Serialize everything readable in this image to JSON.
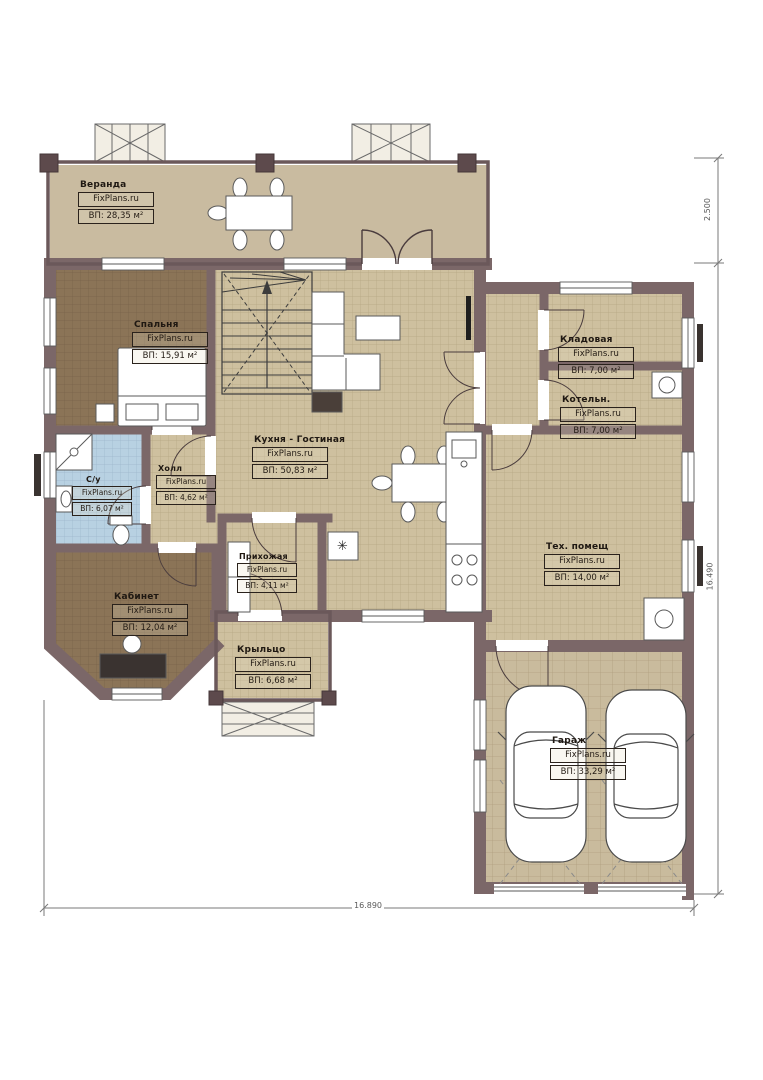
{
  "plan": {
    "watermark": "FixPlans.ru",
    "rooms": [
      {
        "id": "veranda",
        "name": "Веранда",
        "brand": "FixPlans.ru",
        "area": "ВП: 28,35 м²"
      },
      {
        "id": "spalnya",
        "name": "Спальня",
        "brand": "FixPlans.ru",
        "area": "ВП: 15,91 м²"
      },
      {
        "id": "kuhnya-gostinaya",
        "name": "Кухня - Гостиная",
        "brand": "FixPlans.ru",
        "area": "ВП: 50,83 м²"
      },
      {
        "id": "holl",
        "name": "Холл",
        "brand": "FixPlans.ru",
        "area": "ВП: 4,62 м²"
      },
      {
        "id": "sanuzel",
        "name": "С/у",
        "brand": "FixPlans.ru",
        "area": "ВП: 6,07 м²"
      },
      {
        "id": "kabinet",
        "name": "Кабинет",
        "brand": "FixPlans.ru",
        "area": "ВП: 12,04 м²"
      },
      {
        "id": "prihozhaya",
        "name": "Прихожая",
        "brand": "FixPlans.ru",
        "area": "ВП: 4,11 м²"
      },
      {
        "id": "krylco",
        "name": "Крыльцо",
        "brand": "FixPlans.ru",
        "area": "ВП: 6,68 м²"
      },
      {
        "id": "kladovaya",
        "name": "Кладовая",
        "brand": "FixPlans.ru",
        "area": "ВП: 7,00 м²"
      },
      {
        "id": "kotelnaya",
        "name": "Котельн.",
        "brand": "FixPlans.ru",
        "area": "ВП: 7,00 м²"
      },
      {
        "id": "teh-pomesch",
        "name": "Тех. помещ",
        "brand": "FixPlans.ru",
        "area": "ВП: 14,00 м²"
      },
      {
        "id": "garazh",
        "name": "Гараж",
        "brand": "FixPlans.ru",
        "area": "ВП: 33,29 м²"
      }
    ],
    "dimensions": {
      "right_top": "2.500",
      "right_main": "16.490",
      "bottom": "16.890"
    },
    "symbols": {
      "dishwasher": "✳"
    },
    "colors": {
      "wall": "#7b6768",
      "wall_dark": "#453738",
      "floor_tan": "#cec09f",
      "floor_brown": "#8b7457",
      "floor_blue": "#b8d1e2",
      "floor_veranda": "#c9bba0",
      "floor_garage": "#c9bb9d"
    }
  }
}
